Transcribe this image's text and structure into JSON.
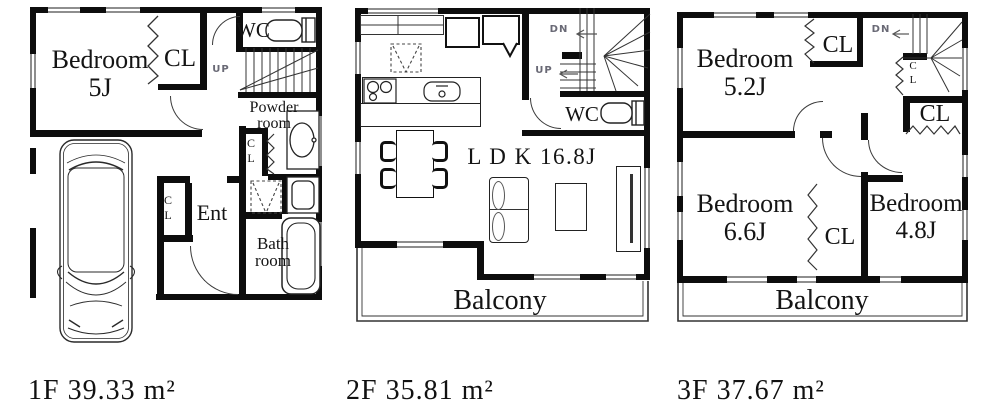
{
  "colors": {
    "wall": "#0d0d0d",
    "line": "#333333",
    "window_gray": "#8e8e8e",
    "muted_label": "#696975"
  },
  "floors": [
    {
      "name": "1F",
      "area_label": "1F 39.33 m²",
      "rooms": {
        "bedroom": {
          "line1": "Bedroom",
          "line2": "5J"
        },
        "cl": "CL",
        "wc": "WC",
        "up": "UP",
        "powder": {
          "line1": "Powder",
          "line2": "room"
        },
        "cl_small_powder": {
          "line1": "C",
          "line2": "L"
        },
        "cl_small_ent": {
          "line1": "C",
          "line2": "L"
        },
        "ent": "Ent",
        "bath": {
          "line1": "Bath",
          "line2": "room"
        }
      }
    },
    {
      "name": "2F",
      "area_label": "2F 35.81 m²",
      "rooms": {
        "cl": "C L",
        "dn": "DN",
        "up": "UP",
        "wc": "WC",
        "ldk": "L D K 16.8J",
        "balcony": "Balcony"
      }
    },
    {
      "name": "3F",
      "area_label": "3F 37.67 m²",
      "rooms": {
        "bedroom1": {
          "line1": "Bedroom",
          "line2": "5.2J"
        },
        "cl_top": "CL",
        "dn": "DN",
        "cl_small_stairs": {
          "line1": "C",
          "line2": "L"
        },
        "cl_under_stairs": "CL",
        "bedroom2": {
          "line1": "Bedroom",
          "line2": "6.6J"
        },
        "cl_mid": "CL",
        "bedroom3": {
          "line1": "Bedroom",
          "line2": "4.8J"
        },
        "balcony": "Balcony"
      }
    }
  ]
}
